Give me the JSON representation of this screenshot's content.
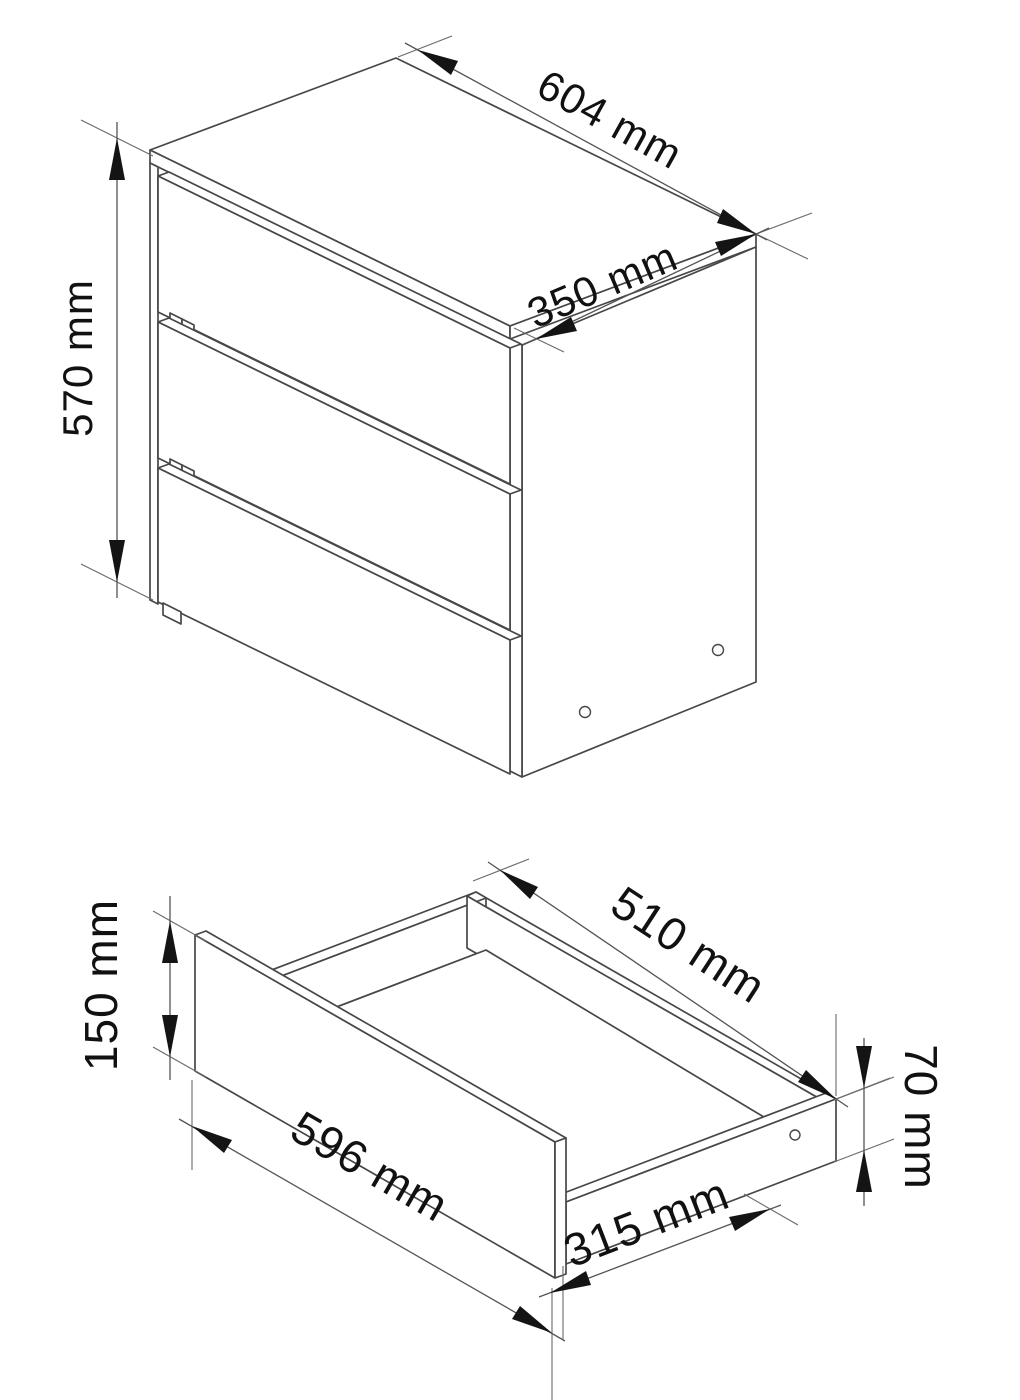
{
  "diagram": {
    "background": "#ffffff",
    "line_color": "#474747",
    "arrow_color": "#141414",
    "cabinet_view": {
      "name": "three-drawer chest isometric view",
      "dim_width": "604 mm",
      "dim_depth": "350 mm",
      "dim_height": "570 mm"
    },
    "drawer_view": {
      "name": "single drawer detail isometric view",
      "dim_front_width": "596 mm",
      "dim_front_height": "150 mm",
      "dim_depth": "510 mm",
      "dim_side_height": "70 mm",
      "dim_bottom_depth": "315 mm"
    }
  }
}
